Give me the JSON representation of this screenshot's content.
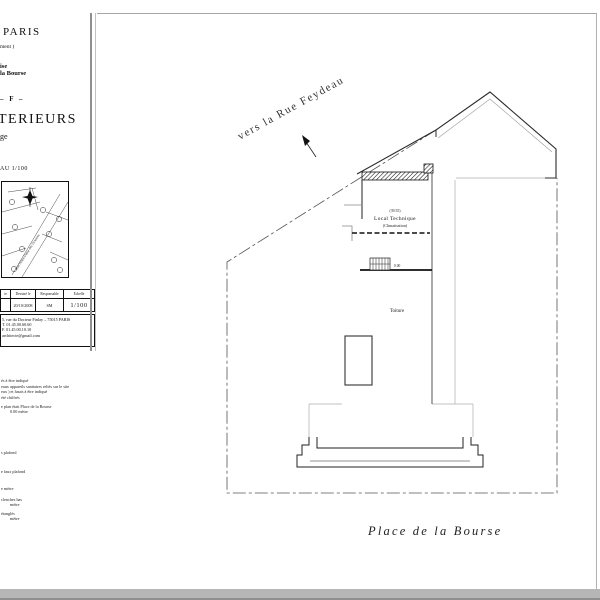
{
  "colors": {
    "sheet_border": "#a6a6a6",
    "bottom_band": "#b6b6b6",
    "ink": "#1a1a1a",
    "light_wall": "#bdbdbd",
    "boundary_line": "#555555"
  },
  "title_block": {
    "city": "PARIS",
    "district": "ment )",
    "project_line1": "ise",
    "project_line2": "la Bourse",
    "permit_ref": "– F  –",
    "title_main": "TERIEURS",
    "title_sub": "ge",
    "scale_note": "AU 1/100",
    "map": {
      "street_label": "Rue Notre-Dame des Victoires",
      "north_icon": "compass-star"
    },
    "table": {
      "headers": [
        "te",
        "Dessiné le",
        "Responsable",
        "Echelle"
      ],
      "row": [
        "",
        "20/10/2008",
        "SM",
        "1/100"
      ]
    },
    "contact": {
      "line1": "5, rue du Docteur Finlay – 75015 PARIS",
      "line2": "T. 01.45.00.60.60",
      "line3": "F. 01.45.00.10.10",
      "line4": "architecte@gmail.com"
    }
  },
  "legend": {
    "para1": "és à être indiqué",
    "para2": "eaux appareils sanitaires reliés sur le site",
    "para3": "eux ) et hauts à être indiqué",
    "para4": "été chiffrés",
    "note1": "e plan était Place de la Bourse",
    "note2": "0.00 mètre",
    "items": [
      {
        "l1": "s plafond",
        "l2": ""
      },
      {
        "l1": "e faux plafond",
        "l2": ""
      },
      {
        "l1": "e mètre",
        "l2": ""
      },
      {
        "l1": "clenches bas",
        "l2": "mètre"
      },
      {
        "l1": "étanglés",
        "l2": "mètre"
      }
    ]
  },
  "plan": {
    "street_top": "vers la Rue Feydeau",
    "street_bottom": "Place  de  la  Bourse",
    "room_level": "(39.55)",
    "room_label": "Local Technique",
    "room_sublabel": "(Climatisation)",
    "area_label": "Toiture",
    "level_zero": "0.00"
  }
}
